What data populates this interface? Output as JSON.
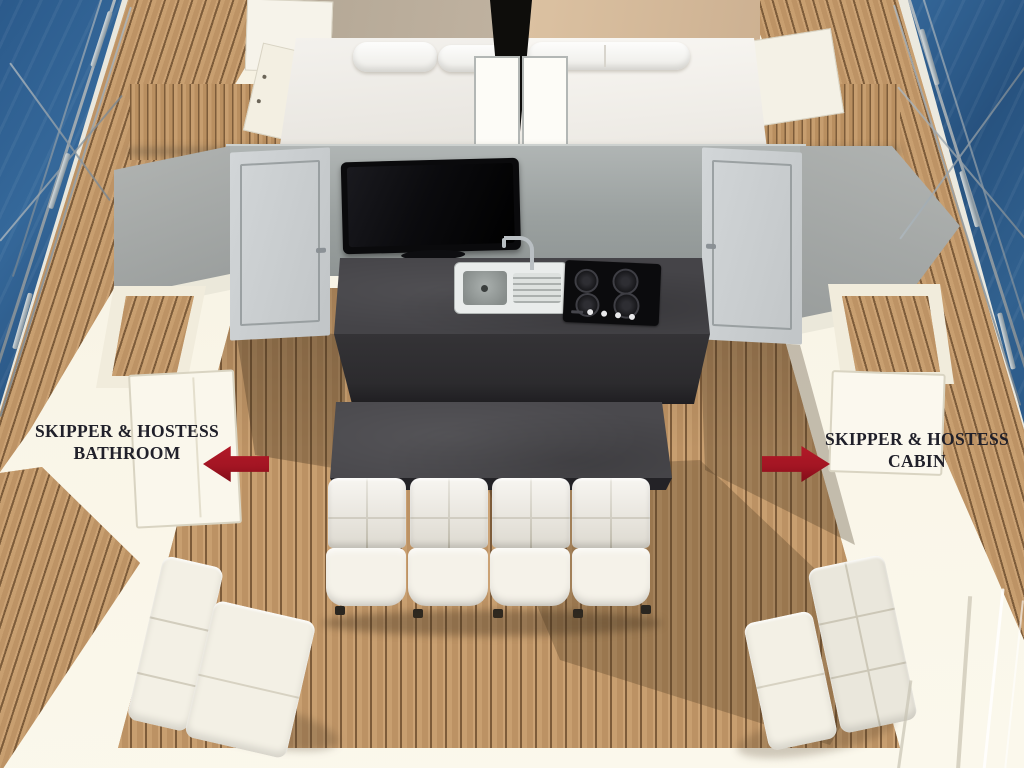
{
  "scene": {
    "type": "yacht-deck-3d-render",
    "annotations": {
      "bathroom_label": {
        "line1": "SKIPPER & HOSTESS",
        "line2": "BATHROOM",
        "arrow": "left"
      },
      "cabin_label": {
        "line1": "SKIPPER & HOSTESS",
        "line2": "CABIN",
        "arrow": "right"
      }
    },
    "objects": [
      "sea water",
      "deck railing with wires",
      "teak side decks",
      "double berth with pillows",
      "mast with white panels",
      "wall-mounted tv",
      "galley island with sink and 4-burner hob",
      "cabin doors",
      "saloon table",
      "four-seat tufted sofa",
      "chaise seats",
      "teak benches",
      "deck lockers"
    ],
    "colors": {
      "water": "#2b5a8b",
      "water_deep": "#27527f",
      "plank_gap": "#7d5c3a",
      "wood": "#c49a6c",
      "cream": "#f7f2e2",
      "wall_grey": "#a1a6a5",
      "door_grey": "#ccd0d2",
      "counter_dark": "#454448",
      "counter_face": "#2c2b2e",
      "table_dark": "#4a494d",
      "tv_black": "#0a0a0c",
      "sofa_white": "#eeeae0",
      "sofa_seam": "#cdc8b8",
      "arrow_red": "#a31523",
      "arrow_red_dark": "#820d18",
      "label_text": "#20202a"
    }
  }
}
